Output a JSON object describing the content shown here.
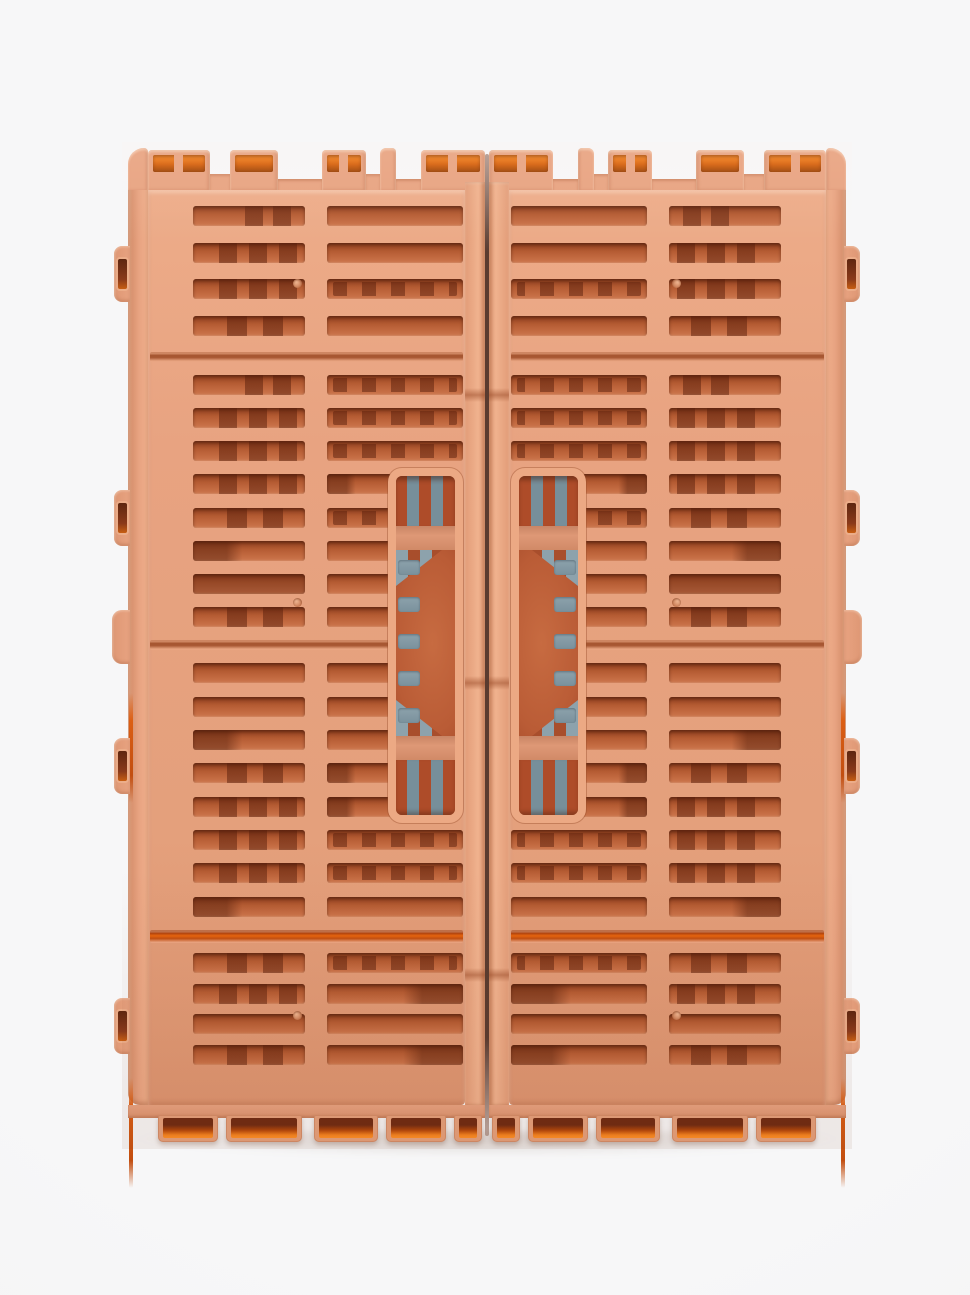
{
  "product": {
    "name": "folded-collapsible-storage-crate",
    "view": "top-down product photo, crate folded flat in two mirrored halves",
    "background_color": "#f5f5f6"
  },
  "palette": {
    "body": "#E8A381",
    "body_light": "#F0B18D",
    "body_shade": "#DD9571",
    "slot_dark": "#8F3E1E",
    "slot_mid": "#B55C33",
    "slot_light": "#CF7A50",
    "rib": "rgba(88,30,11,0.5)",
    "fold_groove": "#A75732",
    "fold_orange": "#E8650D",
    "accent_orange": "#F5831F",
    "accent_orange_dark": "#9C4205",
    "stripe_terracotta": "#AE4C29",
    "stripe_gray": "#778F9A",
    "handle_bg": "#BA5C36",
    "floor_gray": "#8DA2AC",
    "seam": "rgba(62,26,12,0.85)"
  },
  "crate": {
    "left": 128,
    "top": 148,
    "width": 718,
    "height": 995,
    "half_width": 357,
    "seam_width": 4,
    "top_segments": [
      {
        "w": 20,
        "type": "post"
      },
      {
        "w": 62,
        "type": "tab",
        "split": true
      },
      {
        "w": 20,
        "type": "gap"
      },
      {
        "w": 48,
        "type": "tab",
        "split": false
      },
      {
        "w": 44,
        "type": "deep"
      },
      {
        "w": 44,
        "type": "tab",
        "split": true
      },
      {
        "w": 14,
        "type": "gap"
      },
      {
        "w": 16,
        "type": "post"
      },
      {
        "w": 25,
        "type": "deep"
      },
      {
        "w": 64,
        "type": "tab",
        "split": true
      }
    ],
    "sections": [
      {
        "h": 162,
        "rows": [
          {
            "a": "ribsR",
            "b": "plain"
          },
          {
            "a": "ribs3",
            "b": "plain"
          },
          {
            "a": "ribs3",
            "b": "dash"
          },
          {
            "a": "ribs2",
            "b": "plain"
          }
        ]
      },
      {
        "h": 278,
        "rows": [
          {
            "a": "ribsR",
            "b": "dash"
          },
          {
            "a": "ribs3",
            "b": "dash"
          },
          {
            "a": "ribs3",
            "b": "dash"
          },
          {
            "a": "ribs3",
            "b": "darkL",
            "s": true
          },
          {
            "a": "ribs2",
            "b": "dash",
            "s": true
          },
          {
            "a": "darkL",
            "b": "plain",
            "s": true
          },
          {
            "a": "dark",
            "b": "plain",
            "s": true
          },
          {
            "a": "ribs2",
            "b": "plain",
            "s": true
          }
        ]
      },
      {
        "h": 280,
        "rows": [
          {
            "a": "plain",
            "b": "plain",
            "s": true
          },
          {
            "a": "plain",
            "b": "plain",
            "s": true
          },
          {
            "a": "darkL",
            "b": "plain",
            "s": true
          },
          {
            "a": "ribs2",
            "b": "darkL",
            "s": true
          },
          {
            "a": "ribs3",
            "b": "darkL",
            "s": true
          },
          {
            "a": "ribs3",
            "b": "dash"
          },
          {
            "a": "ribs3",
            "b": "dash"
          },
          {
            "a": "darkL",
            "b": "plain"
          }
        ]
      },
      {
        "h": 132,
        "rows": [
          {
            "a": "ribs2",
            "b": "dash"
          },
          {
            "a": "ribs3",
            "b": "darkR"
          },
          {
            "a": "plain",
            "b": "plain"
          },
          {
            "a": "ribs2",
            "b": "darkR"
          }
        ]
      }
    ],
    "fold_styles": [
      "soft",
      "soft",
      "orange"
    ],
    "handle": {
      "x": 260,
      "y": 320,
      "w": 75,
      "h": 355,
      "gray_slots": 5
    },
    "side_tabs": [
      {
        "y": 98,
        "type": "hole"
      },
      {
        "y": 342,
        "type": "hole"
      },
      {
        "y": 462,
        "type": "bump"
      },
      {
        "y": 590,
        "type": "hole"
      },
      {
        "y": 850,
        "type": "hole"
      }
    ],
    "orange_slivers": [
      {
        "y": 545
      },
      {
        "y": 930
      }
    ],
    "feet": [
      {
        "x": 30,
        "w": 60
      },
      {
        "x": 98,
        "w": 76
      },
      {
        "x": 186,
        "w": 64
      },
      {
        "x": 258,
        "w": 60
      },
      {
        "x": 326,
        "w": 28
      }
    ],
    "dimples": [
      [
        165,
        131
      ],
      [
        165,
        450
      ],
      [
        165,
        863
      ]
    ],
    "rail_notches": [
      204,
      492,
      784
    ]
  }
}
